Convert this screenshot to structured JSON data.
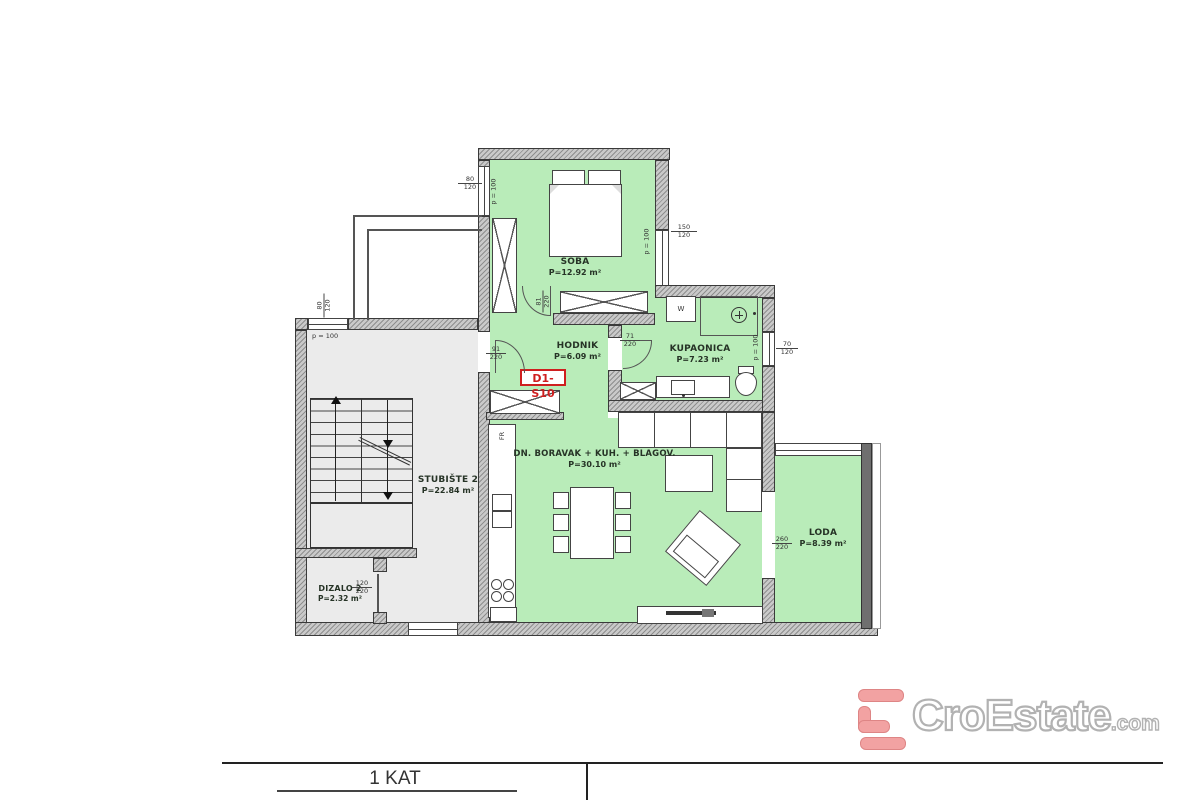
{
  "plan": {
    "unit_label": "D1-S10",
    "rooms": {
      "soba": {
        "name": "SOBA",
        "area": "P=12.92 m²"
      },
      "hodnik": {
        "name": "HODNIK",
        "area": "P=6.09 m²"
      },
      "kupaonica": {
        "name": "KUPAONICA",
        "area": "P=7.23 m²"
      },
      "boravak": {
        "name": "DN. BORAVAK + KUH. + BLAGOV.",
        "area": "P=30.10 m²"
      },
      "stubiste": {
        "name": "STUBIŠTE 2",
        "area": "P=22.84 m²"
      },
      "dizalo": {
        "name": "DIZALO 2",
        "area": "P=2.32 m²"
      },
      "loda": {
        "name": "LODA",
        "area": "P=8.39 m²"
      }
    },
    "dims": {
      "soba_left_win": {
        "w": "80",
        "h": "120"
      },
      "soba_right_win": {
        "w": "150",
        "h": "120"
      },
      "stair_win": {
        "w": "80",
        "h": "120"
      },
      "bath_win": {
        "w": "70",
        "h": "120"
      },
      "soba_door": {
        "w": "81",
        "h": "220"
      },
      "entry_door": {
        "w": "91",
        "h": "220"
      },
      "bath_door": {
        "w": "71",
        "h": "220"
      },
      "dizalo_door": {
        "w": "120",
        "h": "220"
      },
      "loda_door": {
        "w": "260",
        "h": "220"
      }
    },
    "parapet_label": "p = 100",
    "appliances": {
      "washer": "W",
      "fridge": "FR"
    }
  },
  "title_block": {
    "floor_title": "1 KAT"
  },
  "branding": {
    "name": "CroEstate",
    "tld": ".com"
  },
  "colors": {
    "room_green": "#b9ecb9",
    "room_gray": "#ebebeb",
    "wall_gray": "#c9c9c9",
    "accent_red": "#cf1f1f",
    "logo_salmon": "#f2a2a2"
  }
}
